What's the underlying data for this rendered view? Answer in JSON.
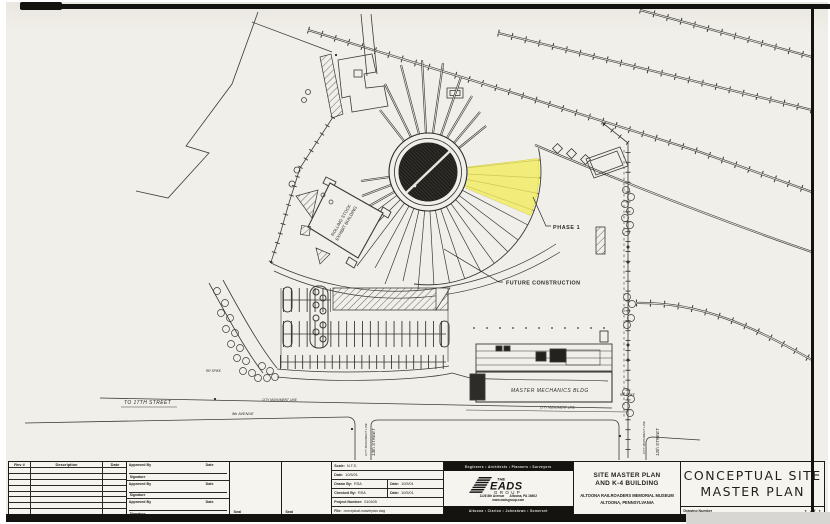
{
  "plan": {
    "phase1": "PHASE 1",
    "future_construction": "FUTURE CONSTRUCTION",
    "rolling_stock_line1": "ROLLING STOCK",
    "rolling_stock_line2": "EXHIBIT BUILDING",
    "master_mechanics": "MASTER MECHANICS BLDG",
    "to_17th_street": "TO 17TH STREET",
    "street_13th": "13th STREET",
    "street_12th": "12th STREET",
    "avenue_9th": "9th AVENUE",
    "city_monument_line": "CITY MONUMENT LINE",
    "rr_spike": "RR SPIKE",
    "colors": {
      "highlight_yellow": "#f2ec5f",
      "ink": "#2c2b27",
      "paper": "#f1efe9"
    }
  },
  "titleblock": {
    "rev_header": {
      "rev": "Rev #",
      "description": "Description",
      "date": "Date"
    },
    "approved_by_label": "Approved By",
    "approval_date_label": "Date",
    "signature_label": "Signature",
    "seal_label": "Seal",
    "fields": {
      "scale_label": "Scale:",
      "scale_value": "N.T.S.",
      "date_label": "Date:",
      "date_value": "10/5/01",
      "drawn_label": "Drawn By:",
      "drawn_value": "RSA",
      "drawn_date_value": "10/5/01",
      "checked_label": "Checked By:",
      "checked_value": "RSA",
      "checked_date_value": "10/5/01",
      "project_label": "Project Number:",
      "project_value": "010405",
      "file_label": "File:",
      "file_value": "conceptual-masterplan.dwg"
    },
    "firm": {
      "services": "Engineers  •  Architects  •  Planners  •  Surveyors",
      "the": "THE",
      "name": "EADS",
      "group": "GROUP",
      "address": "1126 8th Avenue      Altoona, PA 16602",
      "web": "www.eadsgroup.com",
      "offices": "Altoona  •  Clarion  •  Johnstown  •  Somerset"
    },
    "project": {
      "line1": "SITE MASTER PLAN",
      "line2": "AND K-4 BUILDING",
      "line3": "ALTOONA RAILROADERS MEMORIAL MUSEUM",
      "line4": "ALTOONA, PENNSYLVANIA"
    },
    "title_line1": "CONCEPTUAL SITE",
    "title_line2": "MASTER PLAN",
    "drawing_number_label": "Drawing Number",
    "sheet_number": "1 of 1"
  }
}
